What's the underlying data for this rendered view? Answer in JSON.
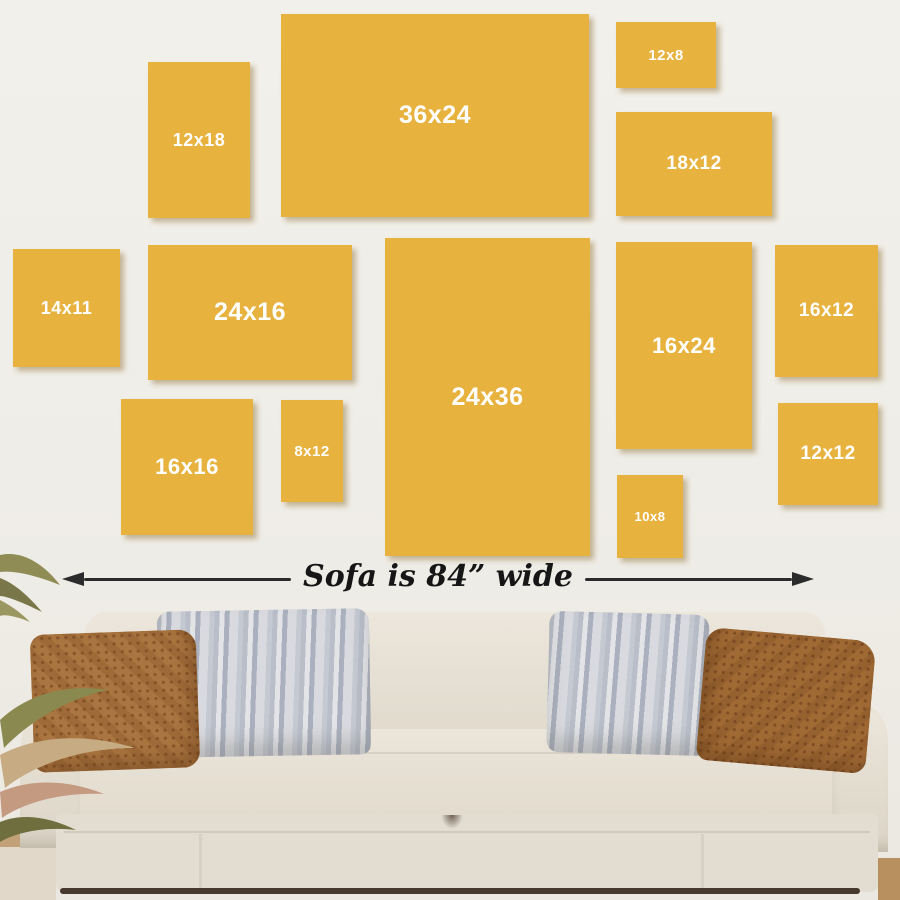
{
  "scene": {
    "description": "Wall art canvas size guide displayed above a sofa",
    "wall_color": "#f0eee8",
    "frame_color": "#e8b23f",
    "frame_label_color": "#ffffff",
    "floor_color": "#c2a178",
    "shadow_color": "#46382c"
  },
  "frames": [
    {
      "label": "12x18",
      "x": 148,
      "y": 62,
      "w": 102,
      "h": 156,
      "font_px": 18
    },
    {
      "label": "36x24",
      "x": 281,
      "y": 14,
      "w": 308,
      "h": 203,
      "font_px": 25
    },
    {
      "label": "12x8",
      "x": 616,
      "y": 22,
      "w": 100,
      "h": 66,
      "font_px": 15
    },
    {
      "label": "18x12",
      "x": 616,
      "y": 112,
      "w": 156,
      "h": 104,
      "font_px": 19
    },
    {
      "label": "14x11",
      "x": 13,
      "y": 249,
      "w": 107,
      "h": 118,
      "font_px": 18
    },
    {
      "label": "24x16",
      "x": 148,
      "y": 245,
      "w": 204,
      "h": 135,
      "font_px": 25
    },
    {
      "label": "16x16",
      "x": 121,
      "y": 399,
      "w": 132,
      "h": 136,
      "font_px": 22
    },
    {
      "label": "8x12",
      "x": 281,
      "y": 400,
      "w": 62,
      "h": 102,
      "font_px": 15
    },
    {
      "label": "24x36",
      "x": 385,
      "y": 238,
      "w": 205,
      "h": 318,
      "font_px": 25
    },
    {
      "label": "16x24",
      "x": 616,
      "y": 242,
      "w": 136,
      "h": 207,
      "font_px": 22
    },
    {
      "label": "16x12",
      "x": 775,
      "y": 245,
      "w": 103,
      "h": 132,
      "font_px": 19
    },
    {
      "label": "12x12",
      "x": 778,
      "y": 403,
      "w": 100,
      "h": 102,
      "font_px": 19
    },
    {
      "label": "10x8",
      "x": 617,
      "y": 475,
      "w": 66,
      "h": 83,
      "font_px": 13
    }
  ],
  "measurement": {
    "label": "Sofa is 84” wide",
    "line_color": "#2b2b2b"
  },
  "sofa": {
    "upholstery_color": "#e8e2d7",
    "pillows": [
      {
        "name": "left-brown-patterned",
        "color": "#a97540"
      },
      {
        "name": "left-gray-striped",
        "color": "#cdd1d8"
      },
      {
        "name": "right-gray-striped",
        "color": "#cdd1d8"
      },
      {
        "name": "right-brown-patterned",
        "color": "#a06a35"
      }
    ]
  },
  "plant": {
    "name": "dried-grass-plant",
    "colors": [
      "#8a8a50",
      "#c7ab82",
      "#c49a80",
      "#6e6e3e"
    ]
  }
}
